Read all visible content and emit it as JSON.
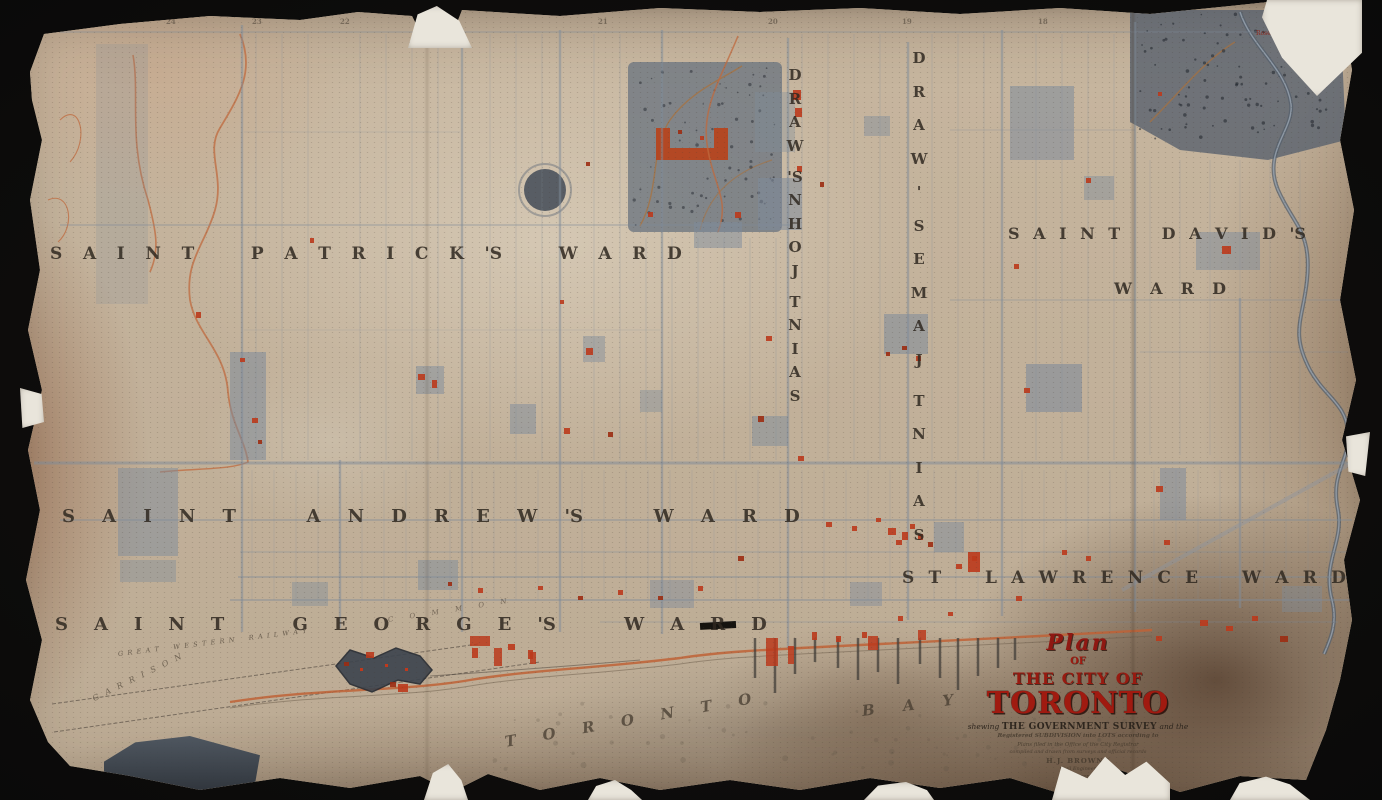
{
  "palette": {
    "background": "#0b0b0b",
    "paper": "#c3b29a",
    "paper_stain_brown": "#7c6450",
    "ink": "#2f2820",
    "title_red": "#9e1a10",
    "building_red": "#bb3a1c",
    "creek_orange": "#bf6a3d",
    "block_blue_gray": "#7e8b9b",
    "river_gray": "#55606c"
  },
  "wards": {
    "patricks": "SAINT PATRICK'S WARD",
    "andrews": "SAINT ANDREW'S WARD",
    "georges": "SAINT GEORGE'S WARD",
    "davids_line1": "SAINT DAVID'S",
    "davids_line2": "WARD",
    "lawrence": "ST LAWRENCE WARD",
    "johns": "SAINT JOHN'S WARD",
    "james": "SAINT JAMES' WARD"
  },
  "bay": {
    "word1": "TORONTO",
    "word2": "BAY"
  },
  "labels": {
    "railway": "GREAT WESTERN RAILWAY",
    "garrison": "GARRISON",
    "common": "COMMON",
    "rose_park": "Rose Park"
  },
  "lot_numbers": [
    "25",
    "24",
    "23",
    "22",
    "21",
    "20",
    "19",
    "18"
  ],
  "cartouche": {
    "plan": "Plan",
    "of": "OF",
    "the_city_of": "THE CITY OF",
    "toronto": "TORONTO",
    "shewing_prefix": "shewing",
    "survey": "THE GOVERNMENT SURVEY",
    "suffix": "and the",
    "fine_print": [
      "Registered SUBDIVISION into LOTS according to",
      "Plans filed in the Office of the City Registrar",
      "compiled and drawn from surveys and official records",
      "H.J. BROWNE",
      "Civil Engineer",
      "Lith. Toronto"
    ]
  }
}
